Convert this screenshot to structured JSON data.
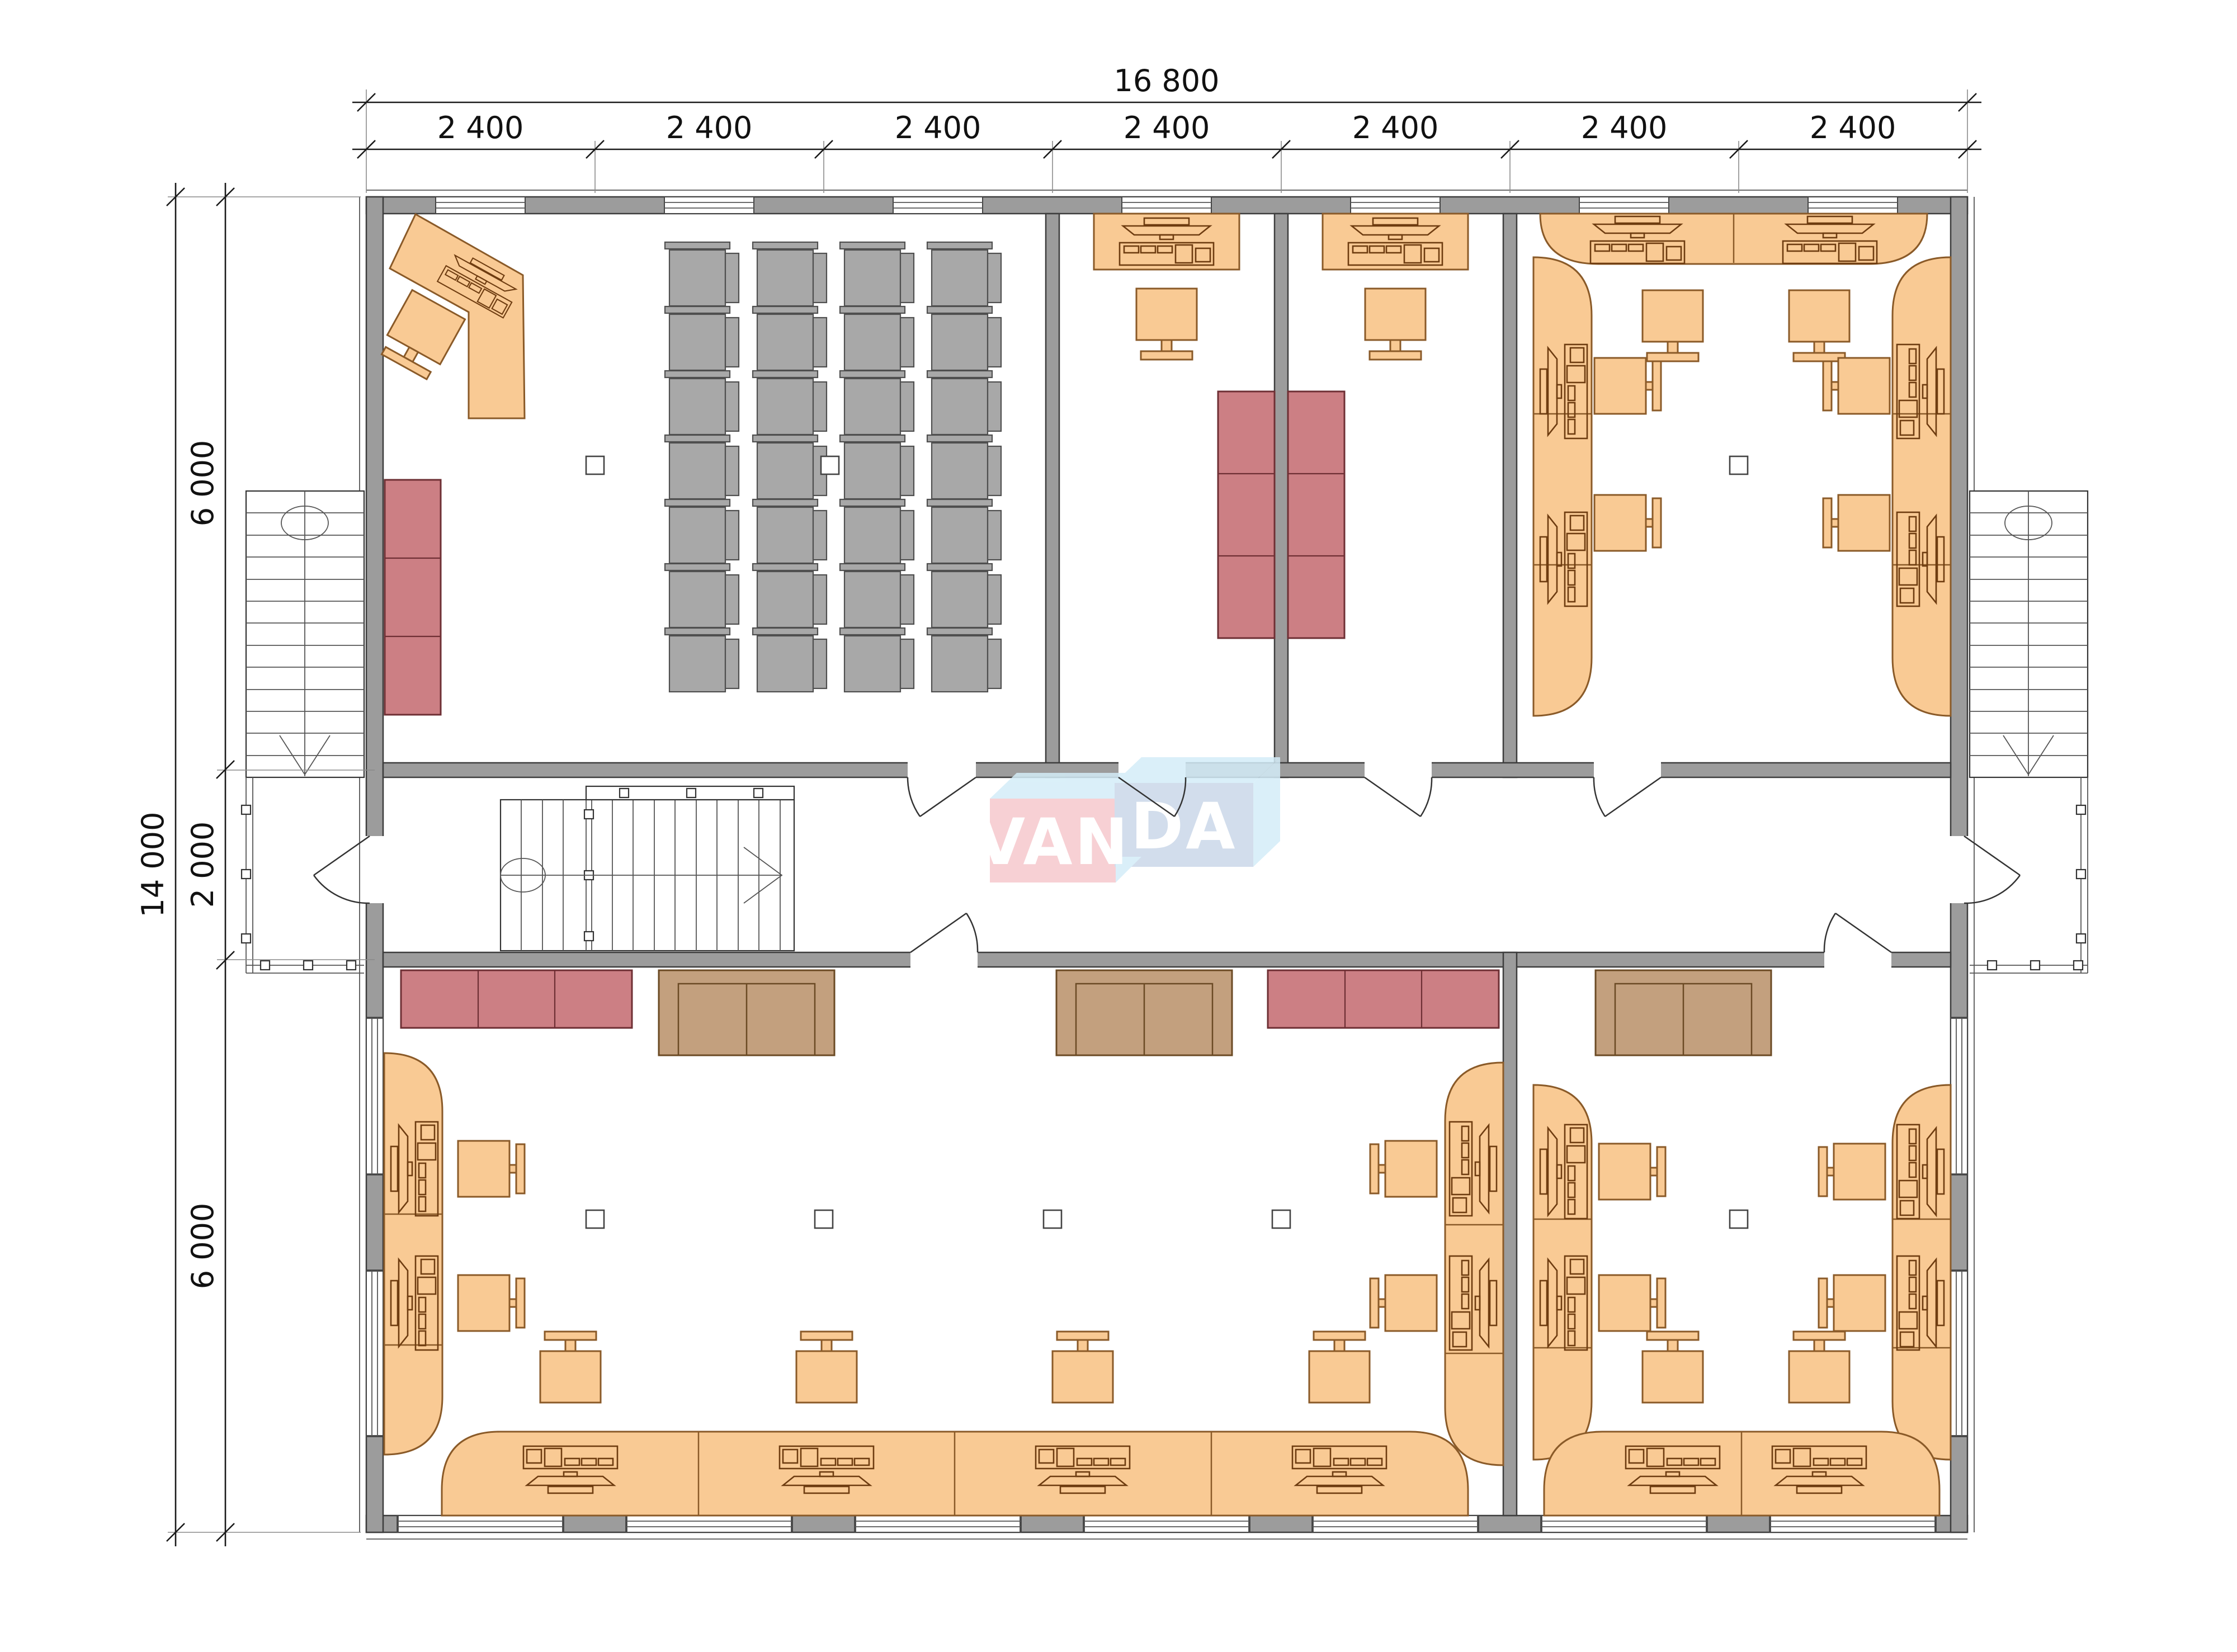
{
  "dimensions": {
    "top_total": "16 800",
    "top_segments": [
      "2 400",
      "2 400",
      "2 400",
      "2 400",
      "2 400",
      "2 400",
      "2 400"
    ],
    "left_total": "14 000",
    "left_segments": [
      "6 000",
      "2 000",
      "6 000"
    ]
  },
  "logo": {
    "left": "VAN",
    "right": "DA"
  },
  "colors": {
    "wall": "#9c9c9c",
    "desk": "#f9ca94",
    "desk_line": "#8a5a28",
    "cabinet": "#cc7f84",
    "cabinet_line": "#6e2f34",
    "sofa": "#c3a07e",
    "sofa_line": "#6b4a24",
    "chair_gray": "#a8a8a8",
    "logo_pink": "#f6c8cd",
    "logo_blue": "#cbd8e9",
    "logo_light_blue": "#d4edf8",
    "logo_text": "#ffffff"
  }
}
